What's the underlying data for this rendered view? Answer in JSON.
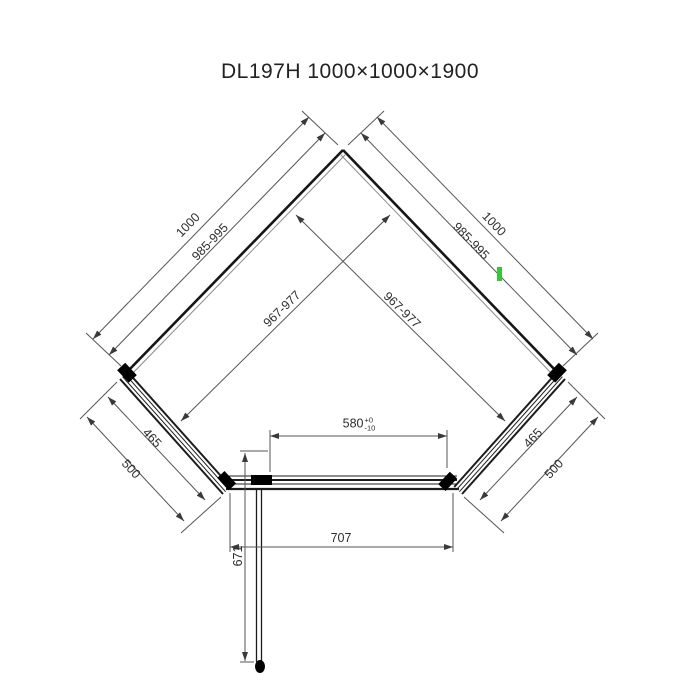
{
  "title": "DL197H 1000×1000×1900",
  "colors": {
    "dimension_line": "#555555",
    "wall_line": "#161616",
    "text": "#2e2e2e",
    "hinge_fill": "#000000",
    "green_marker": "#3bc43b"
  },
  "dimensions": {
    "left_wall_overall": "1000",
    "left_wall_adjust": "985-995",
    "right_wall_overall": "1000",
    "right_wall_adjust": "985-995",
    "left_glass": "967-977",
    "right_glass": "967-977",
    "left_panel_glass": "465",
    "left_panel_overall": "500",
    "right_panel_glass": "465",
    "right_panel_overall": "500",
    "door_opening": {
      "value": "580",
      "tol_plus": "+0",
      "tol_minus": "-10"
    },
    "front_width": "707",
    "door_depth": "671"
  }
}
